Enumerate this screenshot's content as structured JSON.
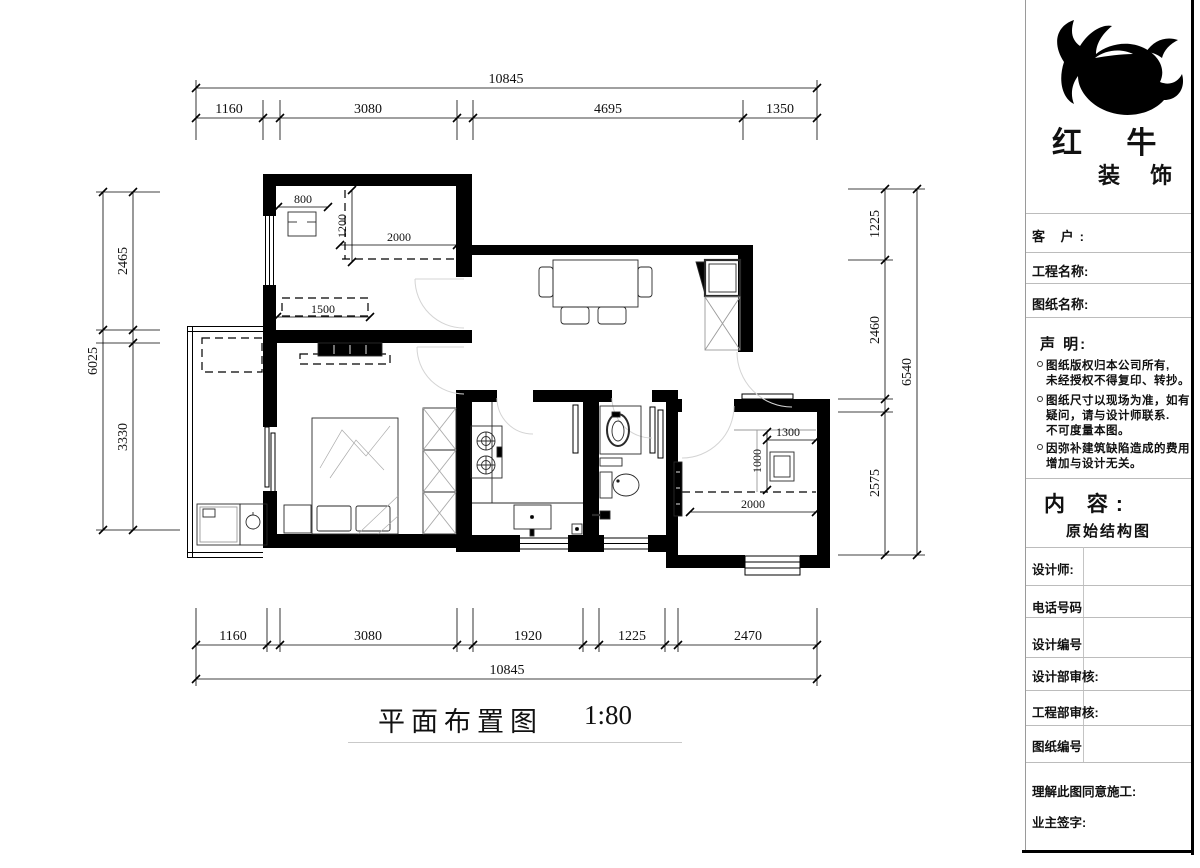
{
  "plan": {
    "title": "平面布置图",
    "scale": "1:80",
    "dims": {
      "top_total": "10845",
      "top1": "1160",
      "top2": "3080",
      "top3": "4695",
      "top4": "1350",
      "bot1": "1160",
      "bot2": "3080",
      "bot3": "1920",
      "bot4": "1225",
      "bot5": "2470",
      "bot_total": "10845",
      "left1": "2465",
      "left2": "3330",
      "left_total": "6025",
      "right1": "1225",
      "right2": "2460",
      "right3": "2575",
      "right_total": "6540",
      "i800": "800",
      "i1200": "1200",
      "i2000a": "2000",
      "i1500": "1500",
      "i1300": "1300",
      "i1000": "1000",
      "i2000b": "2000"
    }
  },
  "titleblock": {
    "brand": {
      "name": "红 牛",
      "sub": "装 饰"
    },
    "fields": {
      "customer": "客  户:",
      "project": "工程名称:",
      "drawing": "图纸名称:"
    },
    "statement": {
      "title": "声 明:",
      "l1": "图纸版权归本公司所有,",
      "l2": "未经授权不得复印、转抄。",
      "l3": "图纸尺寸以现场为准，如有",
      "l4": "疑问，请与设计师联系.",
      "l5": "不可度量本图。",
      "l6": "因弥补建筑缺陷造成的费用",
      "l7": "增加与设计无关。"
    },
    "content": {
      "label": "内 容:",
      "value": "原始结构图"
    },
    "rows": {
      "designer": "设计师:",
      "phone": "电话号码",
      "design_no": "设计编号",
      "design_review": "设计部审核:",
      "eng_review": "工程部审核:",
      "drawing_no": "图纸编号",
      "agree": "理解此图同意施工:",
      "owner_sign": "业主签字:"
    }
  }
}
